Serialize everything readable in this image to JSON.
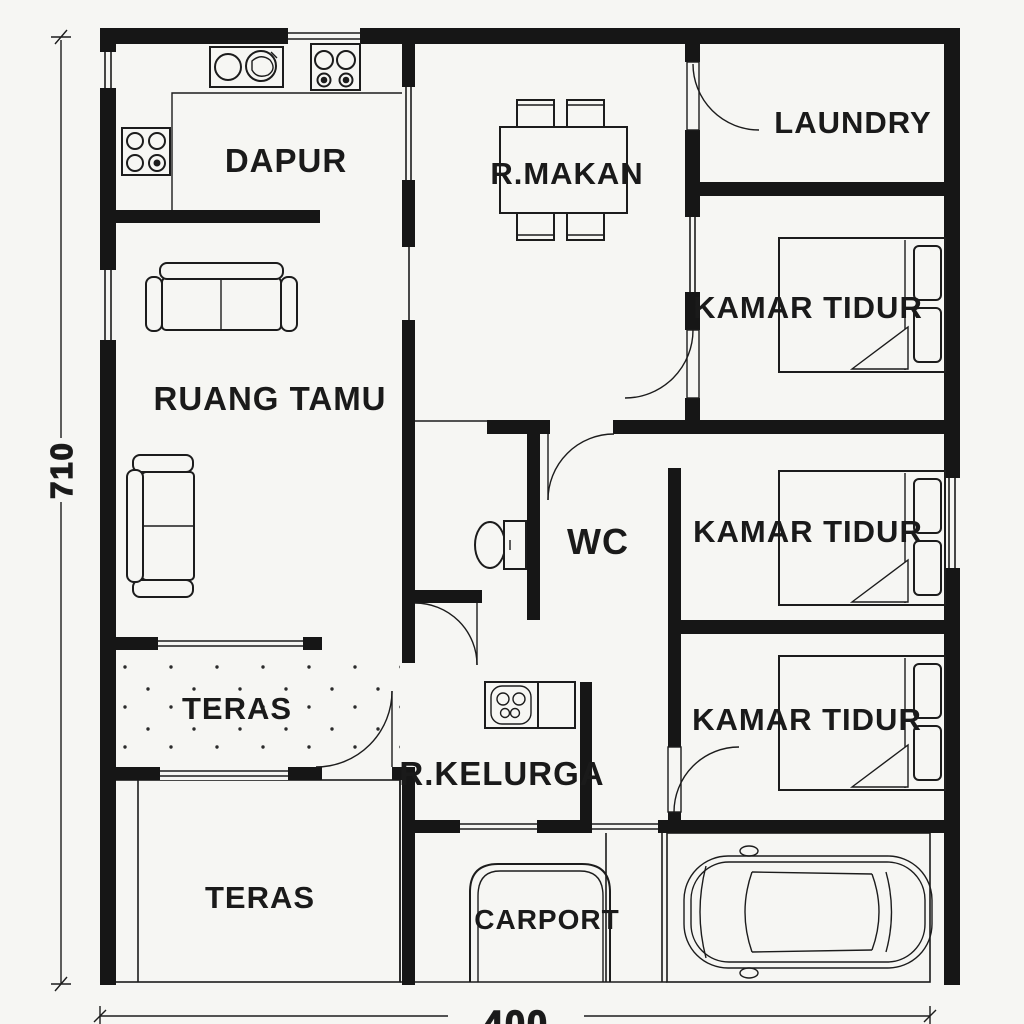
{
  "title": "House floor plan (denah rumah)",
  "colors": {
    "bg": "#f6f6f3",
    "wall": "#161616",
    "line": "#1c1c1c",
    "text": "#1a1a1a"
  },
  "rooms": [
    {
      "id": "dapur",
      "label": "DAPUR"
    },
    {
      "id": "r-makan",
      "label": "R.MAKAN"
    },
    {
      "id": "laundry",
      "label": "LAUNDRY"
    },
    {
      "id": "kamar-tidur-1",
      "label": "KAMAR TIDUR"
    },
    {
      "id": "ruang-tamu",
      "label": "RUANG TAMU"
    },
    {
      "id": "wc",
      "label": "WC"
    },
    {
      "id": "kamar-tidur-2",
      "label": "KAMAR TIDUR"
    },
    {
      "id": "teras-upper",
      "label": "TERAS"
    },
    {
      "id": "r-kelurga",
      "label": "R.KELURGA"
    },
    {
      "id": "kamar-tidur-3",
      "label": "KAMAR TIDUR"
    },
    {
      "id": "teras-lower",
      "label": "TERAS"
    },
    {
      "id": "carport",
      "label": "CARPORT"
    }
  ],
  "dimensions": {
    "height": "710",
    "width": "400"
  },
  "icons": [
    "kitchen-sink-icon",
    "stove-icon",
    "cooktop-icon",
    "dining-table-icon",
    "sofa-icon",
    "bed-icon",
    "toilet-icon",
    "utility-sink-icon",
    "car-icon",
    "door-swing-icon",
    "window-icon"
  ]
}
